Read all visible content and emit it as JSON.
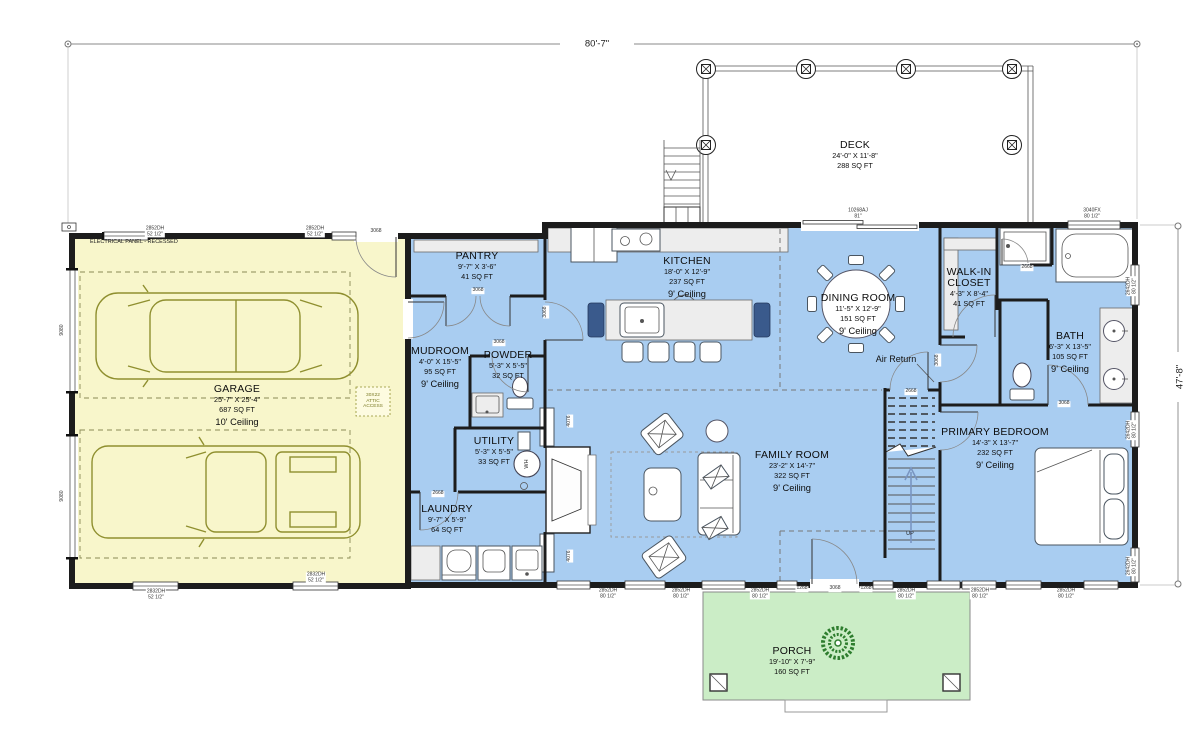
{
  "document": {
    "type": "first-floor-plan"
  },
  "dimensions": {
    "overall_width": "80'-7\"",
    "overall_height": "47'-8\""
  },
  "colors": {
    "interior_blue": "#A9CDF1",
    "garage_yellow": "#F8F6CB",
    "porch_green": "#CBEDC6",
    "wall_dark": "#1C1C1C",
    "fixture_gray": "#EDEDED",
    "vehicle_olive": "#8F8F2F",
    "plant_green": "#2E7D2E",
    "navy_chair": "#3A5A8C",
    "arrow_blue": "#7A96C2",
    "label_gray": "#333333"
  },
  "rooms": [
    {
      "id": "deck",
      "name": "DECK",
      "dims": "24'-0\" X 11'-8\"",
      "sqft": "288 SQ FT",
      "ceiling": "",
      "x": 855,
      "y": 140
    },
    {
      "id": "garage",
      "name": "GARAGE",
      "dims": "25'-7\" X 25'-4\"",
      "sqft": "687 SQ FT",
      "ceiling": "10' Ceiling",
      "x": 237,
      "y": 384
    },
    {
      "id": "pantry",
      "name": "PANTRY",
      "dims": "9'-7\" X 3'-6\"",
      "sqft": "41 SQ FT",
      "ceiling": "",
      "x": 477,
      "y": 251
    },
    {
      "id": "mudroom",
      "name": "MUDROOM",
      "dims": "4'-0\" X 15'-5\"",
      "sqft": "95 SQ FT",
      "ceiling": "9' Ceiling",
      "x": 440,
      "y": 346
    },
    {
      "id": "powder",
      "name": "POWDER",
      "dims": "5'-3\" X 5'-5\"",
      "sqft": "32 SQ FT",
      "ceiling": "",
      "x": 508,
      "y": 350
    },
    {
      "id": "utility",
      "name": "UTILITY",
      "dims": "5'-3\" X 5'-5\"",
      "sqft": "33 SQ FT",
      "ceiling": "",
      "x": 494,
      "y": 436
    },
    {
      "id": "laundry",
      "name": "LAUNDRY",
      "dims": "9'-7\" X 5'-9\"",
      "sqft": "64 SQ FT",
      "ceiling": "",
      "x": 447,
      "y": 504
    },
    {
      "id": "kitchen",
      "name": "KITCHEN",
      "dims": "18'-0\" X 12'-9\"",
      "sqft": "237 SQ FT",
      "ceiling": "9' Ceiling",
      "x": 687,
      "y": 256
    },
    {
      "id": "dining",
      "name": "DINING ROOM",
      "dims": "11'-5\" X 12'-9\"",
      "sqft": "151 SQ FT",
      "ceiling": "9' Ceiling",
      "x": 858,
      "y": 293
    },
    {
      "id": "family",
      "name": "FAMILY ROOM",
      "dims": "23'-2\" X 14'-7\"",
      "sqft": "322 SQ FT",
      "ceiling": "9' Ceiling",
      "x": 792,
      "y": 450
    },
    {
      "id": "closet",
      "name": "WALK-IN\nCLOSET",
      "dims": "4'-3\" X 8'-4\"",
      "sqft": "41 SQ FT",
      "ceiling": "",
      "x": 969,
      "y": 267
    },
    {
      "id": "bath",
      "name": "BATH",
      "dims": "6'-3\" X 13'-5\"",
      "sqft": "105 SQ FT",
      "ceiling": "9' Ceiling",
      "x": 1070,
      "y": 331
    },
    {
      "id": "primary",
      "name": "PRIMARY BEDROOM",
      "dims": "14'-3\" X 13'-7\"",
      "sqft": "232 SQ FT",
      "ceiling": "9' Ceiling",
      "x": 995,
      "y": 427
    },
    {
      "id": "porch",
      "name": "PORCH",
      "dims": "19'-10\" X 7'-9\"",
      "sqft": "160 SQ FT",
      "ceiling": "",
      "x": 792,
      "y": 646
    }
  ],
  "labels": [
    {
      "text": "80'-7\"",
      "x": 597,
      "y": 44,
      "rot": 0,
      "cls": "dim",
      "name": "overall-width-dimension"
    },
    {
      "text": "47'-8\"",
      "x": 1180,
      "y": 377,
      "rot": -90,
      "cls": "dim",
      "name": "overall-height-dimension"
    },
    {
      "text": "ELECTRICAL PANEL - RECESSED",
      "x": 90,
      "y": 242,
      "cls": "note",
      "align": "left",
      "name": "electrical-panel-note"
    },
    {
      "text": "30X22\nATTIC\nACCESS",
      "x": 373,
      "y": 401,
      "cls": "attic",
      "name": "attic-access-note"
    },
    {
      "text": "Air Return",
      "x": 896,
      "y": 359,
      "cls": "midtext",
      "name": "air-return-note"
    },
    {
      "text": "UP",
      "x": 910,
      "y": 534,
      "cls": "note",
      "name": "stairs-up-note"
    },
    {
      "text": "WH",
      "x": 527,
      "y": 464,
      "rot": -90,
      "cls": "note",
      "name": "water-heater-label"
    },
    {
      "text": "2852DH\n52 1/2\"",
      "x": 155,
      "y": 232,
      "cls": "win"
    },
    {
      "text": "2852DH\n52 1/2\"",
      "x": 315,
      "y": 232,
      "cls": "win"
    },
    {
      "text": "3068",
      "x": 376,
      "y": 232,
      "cls": "doorlab"
    },
    {
      "text": "10268AJ\n81\"",
      "x": 858,
      "y": 214,
      "cls": "win"
    },
    {
      "text": "3040FX\n80 1/2\"",
      "x": 1092,
      "y": 214,
      "cls": "win"
    },
    {
      "text": "9080",
      "x": 63,
      "y": 330,
      "rot": -90,
      "cls": "win"
    },
    {
      "text": "9080",
      "x": 63,
      "y": 496,
      "rot": -90,
      "cls": "win"
    },
    {
      "text": "2642DH\n80 1/2\"",
      "x": 1132,
      "y": 286,
      "rot": -90,
      "cls": "win"
    },
    {
      "text": "2642DH\n80 1/2\"",
      "x": 1132,
      "y": 430,
      "rot": -90,
      "cls": "win"
    },
    {
      "text": "2642DH\n80 1/2\"",
      "x": 1132,
      "y": 566,
      "rot": -90,
      "cls": "win"
    },
    {
      "text": "2832DH\n52 1/2\"",
      "x": 156,
      "y": 595,
      "cls": "win"
    },
    {
      "text": "2832DH\n52 1/2\"",
      "x": 316,
      "y": 578,
      "cls": "win"
    },
    {
      "text": "2852DH\n80 1/2\"",
      "x": 608,
      "y": 594,
      "cls": "win"
    },
    {
      "text": "2852DH\n80 1/2\"",
      "x": 681,
      "y": 594,
      "cls": "win"
    },
    {
      "text": "2852DH\n80 1/2\"",
      "x": 760,
      "y": 594,
      "cls": "win"
    },
    {
      "text": "1268",
      "x": 802,
      "y": 589,
      "cls": "doorlab"
    },
    {
      "text": "3068",
      "x": 835,
      "y": 589,
      "cls": "doorlab"
    },
    {
      "text": "1268",
      "x": 866,
      "y": 589,
      "cls": "doorlab"
    },
    {
      "text": "2852DH\n80 1/2\"",
      "x": 906,
      "y": 594,
      "cls": "win"
    },
    {
      "text": "2852DH\n80 1/2\"",
      "x": 980,
      "y": 594,
      "cls": "win"
    },
    {
      "text": "2852DH\n80 1/2\"",
      "x": 1066,
      "y": 594,
      "cls": "win"
    },
    {
      "text": "3068",
      "x": 478,
      "y": 291,
      "cls": "doorlab"
    },
    {
      "text": "3068",
      "x": 499,
      "y": 343,
      "cls": "doorlab"
    },
    {
      "text": "3068",
      "x": 546,
      "y": 312,
      "rot": -90,
      "cls": "doorlab"
    },
    {
      "text": "2668",
      "x": 438,
      "y": 494,
      "cls": "doorlab"
    },
    {
      "text": "2668",
      "x": 911,
      "y": 392,
      "cls": "doorlab"
    },
    {
      "text": "2668",
      "x": 1027,
      "y": 268,
      "cls": "doorlab"
    },
    {
      "text": "3068",
      "x": 938,
      "y": 360,
      "rot": -90,
      "cls": "doorlab"
    },
    {
      "text": "3068",
      "x": 1064,
      "y": 404,
      "cls": "doorlab"
    },
    {
      "text": "4076",
      "x": 570,
      "y": 421,
      "rot": -90,
      "cls": "doorlab"
    },
    {
      "text": "4076",
      "x": 570,
      "y": 556,
      "rot": -90,
      "cls": "doorlab"
    }
  ]
}
